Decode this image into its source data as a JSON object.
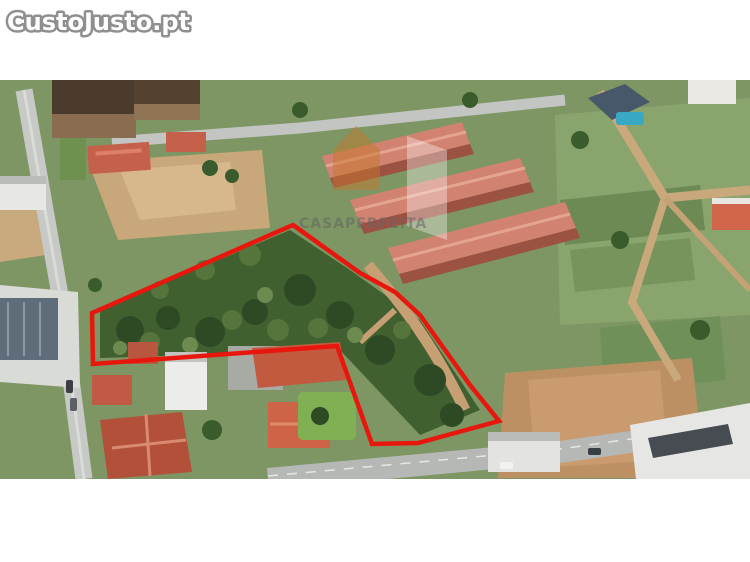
{
  "page": {
    "width": 750,
    "height": 562,
    "background": "#ffffff"
  },
  "watermarks": {
    "brand": {
      "text": "CustoJusto.pt",
      "fill": "#ffffff",
      "outline": "#8f8f8f"
    },
    "agency": {
      "text": "CASAPERFEITA",
      "text_color": "rgba(100,100,100,0.55)",
      "logo_orange": "rgba(198,120,42,0.48)",
      "logo_white": "rgba(255,255,255,0.35)"
    }
  },
  "photo": {
    "description": "Oblique aerial photograph of a residential neighborhood with a wooded land parcel outlined in red",
    "parcel_outline": {
      "color": "#e8170e",
      "stroke_width": 4.5,
      "points": [
        [
          92,
          233
        ],
        [
          293,
          145
        ],
        [
          360,
          193
        ],
        [
          395,
          212
        ],
        [
          420,
          235
        ],
        [
          445,
          270
        ],
        [
          470,
          305
        ],
        [
          499,
          341
        ],
        [
          418,
          363
        ],
        [
          372,
          364
        ],
        [
          337,
          266
        ],
        [
          93,
          284
        ]
      ]
    }
  }
}
